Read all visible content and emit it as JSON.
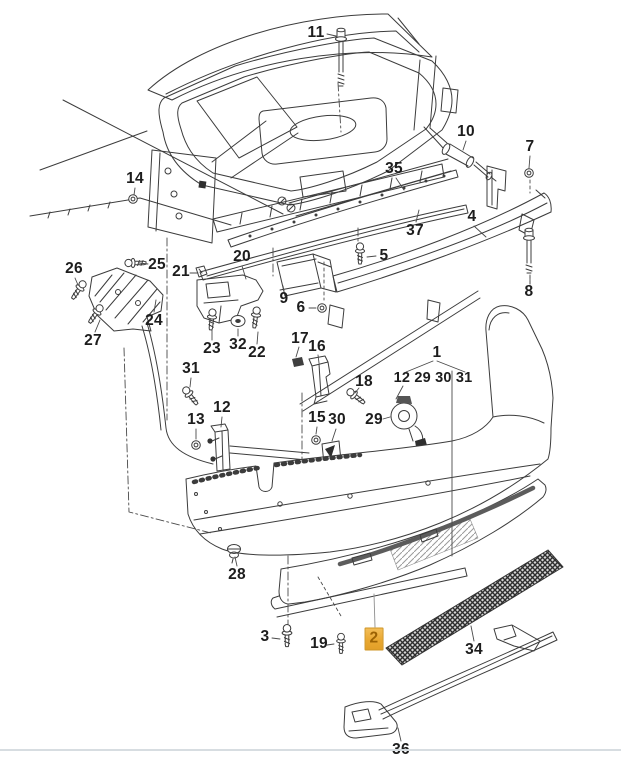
{
  "diagram": {
    "type": "exploded-parts-diagram",
    "subject": "rear-bumper-assembly",
    "line_color": "#3c3c3c",
    "leader_color": "#4a4a4a",
    "background_color": "#ffffff",
    "bottom_rule_color": "#d7dde1",
    "highlight": {
      "part": "2",
      "background_color": "#e9a832",
      "border_color": "#cf9526",
      "text_color": "#9c6203"
    },
    "group_callout": {
      "parent": "1",
      "members": "12 29 30 31"
    },
    "callouts": [
      {
        "label": "11",
        "x": 316,
        "y": 33,
        "leader": [
          327,
          34,
          336,
          36
        ]
      },
      {
        "label": "14",
        "x": 135,
        "y": 179,
        "leader": [
          135,
          188,
          134,
          195
        ]
      },
      {
        "label": "10",
        "x": 466,
        "y": 132,
        "leader": [
          466,
          141,
          463,
          150
        ]
      },
      {
        "label": "7",
        "x": 530,
        "y": 147,
        "leader": [
          530,
          156,
          529,
          168
        ]
      },
      {
        "label": "35",
        "x": 394,
        "y": 169,
        "leader": [
          396,
          178,
          404,
          190
        ]
      },
      {
        "label": "4",
        "x": 472,
        "y": 217,
        "leader": [
          474,
          226,
          486,
          237
        ]
      },
      {
        "label": "37",
        "x": 415,
        "y": 231,
        "leader": [
          416,
          222,
          419,
          210
        ]
      },
      {
        "label": "5",
        "x": 384,
        "y": 256,
        "leader": [
          376,
          256,
          367,
          257
        ]
      },
      {
        "label": "8",
        "x": 529,
        "y": 292,
        "leader": [
          530,
          284,
          530,
          276
        ]
      },
      {
        "label": "26",
        "x": 74,
        "y": 269,
        "leader": [
          75,
          278,
          78,
          285
        ]
      },
      {
        "label": "25",
        "x": 157,
        "y": 265,
        "leader": [
          148,
          264,
          139,
          263
        ]
      },
      {
        "label": "21",
        "x": 181,
        "y": 272,
        "leader": [
          190,
          273,
          198,
          273
        ]
      },
      {
        "label": "20",
        "x": 242,
        "y": 257,
        "leader": [
          242,
          266,
          246,
          279
        ]
      },
      {
        "label": "9",
        "x": 284,
        "y": 299,
        "leader": [
          284,
          291,
          283,
          286
        ]
      },
      {
        "label": "6",
        "x": 301,
        "y": 308,
        "leader": [
          309,
          308,
          316,
          308
        ]
      },
      {
        "label": "24",
        "x": 154,
        "y": 321,
        "leader": [
          154,
          312,
          156,
          300
        ]
      },
      {
        "label": "27",
        "x": 93,
        "y": 341,
        "leader": [
          95,
          332,
          100,
          320
        ]
      },
      {
        "label": "23",
        "x": 212,
        "y": 349,
        "leader": [
          212,
          340,
          212,
          330
        ]
      },
      {
        "label": "32",
        "x": 238,
        "y": 345,
        "leader": [
          238,
          336,
          238,
          329
        ]
      },
      {
        "label": "22",
        "x": 257,
        "y": 353,
        "leader": [
          257,
          344,
          258,
          332
        ]
      },
      {
        "label": "17",
        "x": 300,
        "y": 339,
        "leader": [
          299,
          347,
          296,
          357
        ]
      },
      {
        "label": "16",
        "x": 317,
        "y": 347,
        "leader": [
          318,
          355,
          319,
          363
        ]
      },
      {
        "label": "1",
        "x": 437,
        "y": 353,
        "leader": null
      },
      {
        "label": "18",
        "x": 364,
        "y": 382,
        "leader": [
          359,
          388,
          355,
          393
        ]
      },
      {
        "label": "31",
        "x": 191,
        "y": 369,
        "leader": [
          191,
          378,
          190,
          387
        ]
      },
      {
        "label": "12",
        "x": 222,
        "y": 408,
        "leader": [
          222,
          417,
          221,
          427
        ]
      },
      {
        "label": "13",
        "x": 196,
        "y": 420,
        "leader": [
          196,
          429,
          196,
          439
        ]
      },
      {
        "label": "15",
        "x": 317,
        "y": 418,
        "leader": [
          317,
          427,
          316,
          434
        ]
      },
      {
        "label": "30",
        "x": 337,
        "y": 420,
        "leader": [
          336,
          429,
          332,
          441
        ]
      },
      {
        "label": "29",
        "x": 374,
        "y": 420,
        "leader": [
          383,
          419,
          390,
          417
        ]
      },
      {
        "label": "12 29 30 31",
        "x": 433,
        "y": 378,
        "leader": null,
        "group": true
      },
      {
        "label": "28",
        "x": 237,
        "y": 575,
        "leader": [
          237,
          566,
          235,
          557
        ]
      },
      {
        "label": "3",
        "x": 265,
        "y": 637,
        "leader": [
          272,
          638,
          280,
          639
        ]
      },
      {
        "label": "19",
        "x": 319,
        "y": 644,
        "leader": [
          327,
          645,
          334,
          644
        ]
      },
      {
        "label": "2",
        "x": 374,
        "y": 639,
        "highlighted": true,
        "leader": [
          375,
          627,
          374,
          594
        ],
        "leader_color": "#8f8f8f"
      },
      {
        "label": "34",
        "x": 474,
        "y": 650,
        "leader": [
          474,
          641,
          471,
          626
        ]
      },
      {
        "label": "36",
        "x": 401,
        "y": 750,
        "leader": [
          401,
          741,
          398,
          728
        ]
      }
    ]
  }
}
